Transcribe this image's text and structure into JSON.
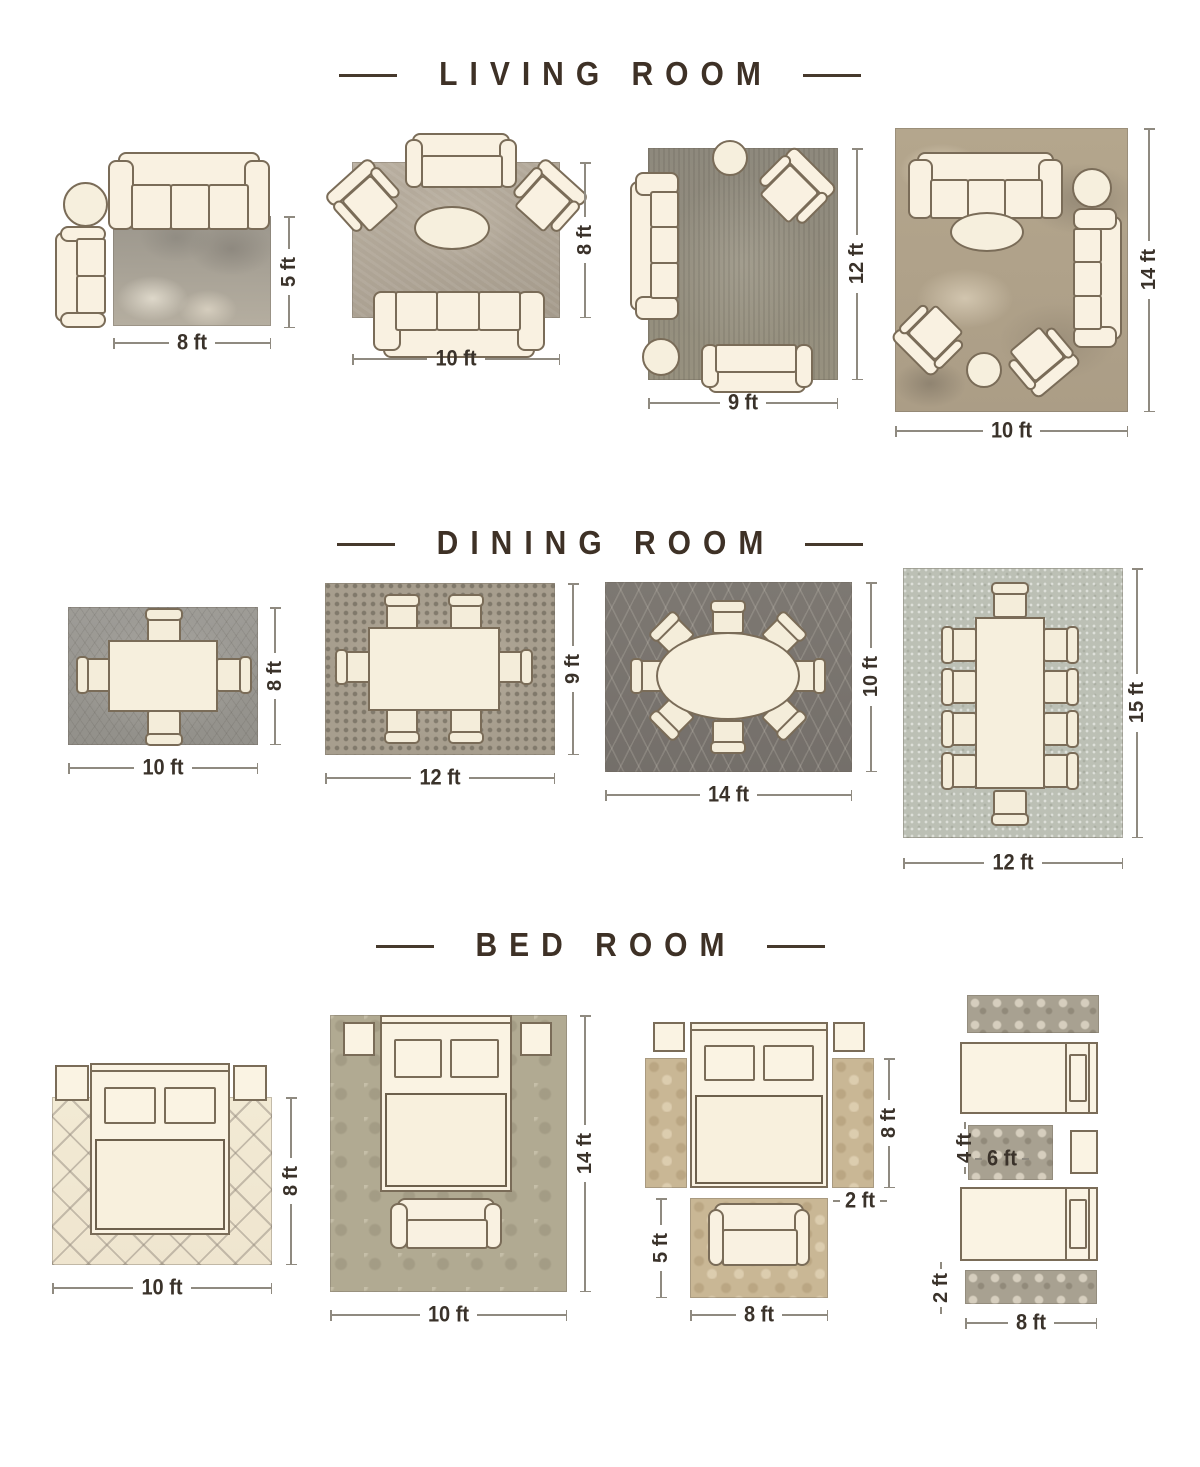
{
  "doc": {
    "type": "rug-size-guide-infographic",
    "background": "#ffffff",
    "title_text_color": "#3e3126",
    "dimension_text_color": "#3a322a",
    "furniture_fill": "#f9f1e1",
    "furniture_outline": "#7a6c58"
  },
  "titles": {
    "living": "LIVING ROOM",
    "dining": "DINING ROOM",
    "bed": "BED ROOM"
  },
  "living": {
    "l1": {
      "w": "8 ft",
      "h": "5 ft"
    },
    "l2": {
      "w": "10 ft",
      "h": "8 ft"
    },
    "l3": {
      "w": "9 ft",
      "h": "12 ft"
    },
    "l4": {
      "w": "10 ft",
      "h": "14 ft"
    }
  },
  "dining": {
    "l1": {
      "w": "10 ft",
      "h": "8 ft"
    },
    "l2": {
      "w": "12 ft",
      "h": "9 ft"
    },
    "l3": {
      "w": "14 ft",
      "h": "10 ft"
    },
    "l4": {
      "w": "12 ft",
      "h": "15 ft"
    }
  },
  "bed": {
    "l1": {
      "w": "10 ft",
      "h": "8 ft"
    },
    "l2": {
      "w": "10 ft",
      "h": "14 ft"
    },
    "l3": {
      "bed_h": "8 ft",
      "runner_w": "2 ft",
      "rug_h": "5 ft",
      "rug_w": "8 ft"
    },
    "l4": {
      "small_h": "4 ft",
      "small_w": "6 ft",
      "runner_h": "2 ft",
      "runner_w": "8 ft"
    }
  }
}
